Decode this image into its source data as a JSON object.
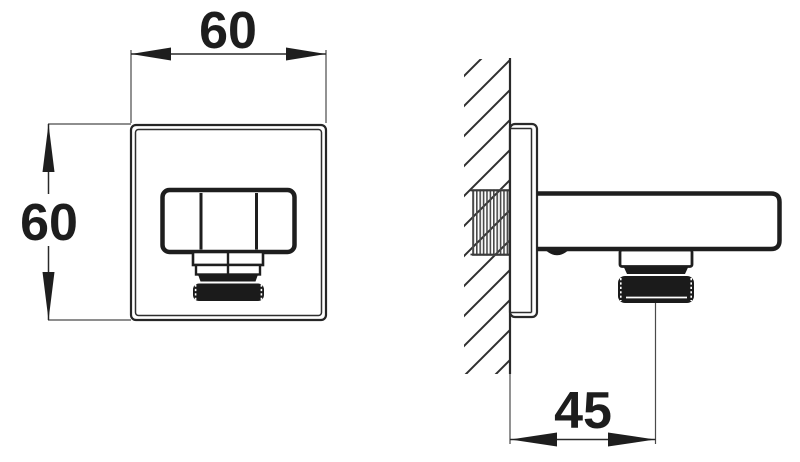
{
  "drawing": {
    "type": "technical-dimension-drawing",
    "subject": "square-wall-outlet-elbow",
    "views": {
      "front": {
        "width_label": "60",
        "height_label": "60"
      },
      "side": {
        "offset_label": "45"
      }
    },
    "colors": {
      "line": "#2a2a2a",
      "thick_line": "#1e1e1e",
      "solid_fill": "#1b1b1b",
      "background": "#ffffff"
    }
  }
}
